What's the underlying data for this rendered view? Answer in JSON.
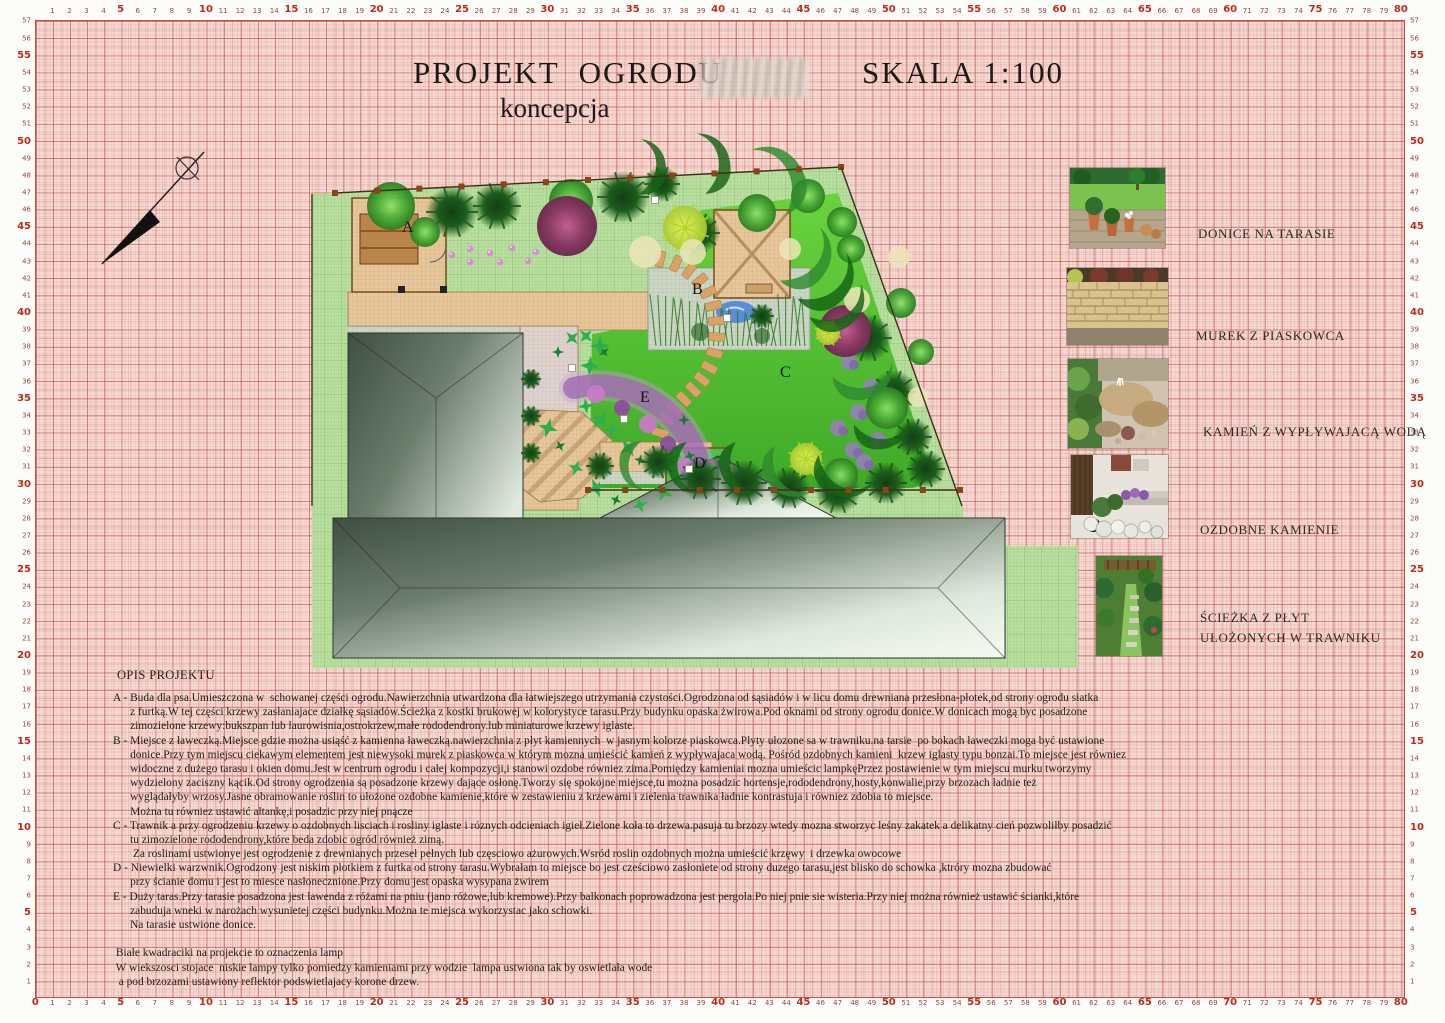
{
  "title": {
    "main": "PROJEKT  OGRODU",
    "scale": "SKALA 1:100",
    "subtitle": "koncepcja"
  },
  "legend": {
    "items": [
      {
        "caption": "DONICE NA TARASIE"
      },
      {
        "caption": "MUREK Z PIASKOWCA"
      },
      {
        "caption": "KAMIEŃ Z WYPŁYWAJACĄ WODĄ"
      },
      {
        "caption": "OZDOBNE KAMIENIE"
      },
      {
        "caption": "ŚCIEŻKA Z PŁYT\nUŁOŻONYCH W TRAWNIKU"
      }
    ]
  },
  "description": {
    "heading": "OPIS PROJEKTU",
    "lines": [
      "A - Buda dla psa.Umieszczona w  schowanej części ogrodu.Nawierzchnia utwardzona dla łatwiejszego utrzymania czystości.Ogrodzona od sąsiadów i w licu domu drewniana przesłona-płotek,od strony ogrodu siatka",
      "      z furtką.W tej części krzewy zasłaniajace działkę sąsiadów.Ścieżka z kostki brukowej w kolorystyce tarasu.Przy budynku opaska żwirowa.Pod oknami od strony ogrodu donice.W donicach mogą byc posadzone",
      "      zimozielone krzewy:bukszpan lub laurowisnia,ostrokrzew,małe rododendrony.lub miniaturowe krzewy iglaste.",
      "B - Miejsce z ławeczką.Miejsce gdzie można usiąść z kamienna ławeczką.nawierzchnia z płyt kamiennych  w jasnym kolorze piaskowca.Płyty ułozone sa w trawniku.na tarsie  po bokach ławeczki moga być ustawione",
      "      donice.Przy tym miejscu ciekawym elementem jest niewysoki murek z piaskowca w którym mozna umieścić kamień z wypływajaca wodą. Pośród ozdobnych kamieni  krzew iglasty typu bonzai.To miejsce jest równiez",
      "      widoczne z dużego tarasu i okien domu.Jest w centrum ogrodu i całej kompozycji,i stanowi ozdobe równiez zima.Pomiędzy kamieniai mozna umieścic lampkęPrzez postawienie w tym miejscu murku tworzymy",
      "      wydzielony zaciszny kącik.Od strony ogrodzenia są posadzone krzewy dające osłonę.Tworzy się spokojne miejsce,tu mozna posadzic hortensje,rododendrony,hosty,konwalie,przy brzozach ładnie też",
      "      wyglądałyby wrzosy.Jasne obramowanie roślin to ułożone ozdobne kamienie,które w zestawieniu z krzewami i zielenia trawnika ładnie kontrastuja i równiez zdobia to miejsce.",
      "      Można tu równiez ustawić altankę,i posadzic przy niej pnącze",
      "C - Trawnik a przy ogrodzeniu krzewy o ozdobnych lisciach i rosliny iglaste i róznych odcieniach igieł.Zielone koła to drzewa.pasuja tu brzozy wtedy mozna stworzyc leśny zakatek a delikatny cień pozwoliłby posadzić",
      "      tu zimozielone rododendrony,które beda zdobic ogród również zimą.",
      "       Za roslinami ustwionye jest ogrodzenie z drewnianych przeseł pełnych lub częsciowo ażurowych.Wsród roslin ozdobnych można umieścić krzęwy  i drzewka owocowe",
      "D - Niewielki warzwnik.Ogrodzony jest niskim płotkiem z furtka od strony tarasu.Wybrałam to miejsce bo jest cześciowo zasłoniete od strony duzego tarasu,jest blisko do schowka ,ktróry mozna zbudować",
      "      przy ścianie domu i jest to miesce nasłonecznione.Przy domu jest opaska wysypana żwirem",
      "E - Duży taras.Przy tarasie posadzona jest lawenda z różami na pniu (jano różowe,lub kremowe).Przy balkonach poprowadzona jest pergola.Po niej pnie sie wisteria.Przy niej można również ustawić ścianki,które",
      "      zabuduja wneki w narożach wysunietej części budynku.Można te miejsca wykorzystac jako schowki.",
      "      Na tarasie ustwione donice.",
      "",
      " Białe kwadraciki na projekcie to oznaczenia lamp",
      " W wiekszosci stojace  niskie lampy tylko pomiedzy kamieniami przy wodzie  lampa ustwiona tak by oswietlała wode",
      "  a pod brzozami ustawiony reflektor podswietlajacy korone drzew."
    ]
  },
  "rulers": {
    "top": {
      "from": 1,
      "to": 80,
      "overrides": {
        "70": "60"
      }
    },
    "bottom": {
      "from": 0,
      "to": 80,
      "overrides": {}
    },
    "left": {
      "from": 1,
      "to": 57
    },
    "right": {
      "from": 1,
      "to": 57
    }
  },
  "plan": {
    "labels": [
      {
        "t": "A",
        "x": 402,
        "y": 232
      },
      {
        "t": "B",
        "x": 692,
        "y": 294
      },
      {
        "t": "C",
        "x": 780,
        "y": 377
      },
      {
        "t": "D",
        "x": 694,
        "y": 468
      },
      {
        "t": "E",
        "x": 640,
        "y": 402
      }
    ],
    "trees": {
      "conif": [
        [
          452,
          212,
          26
        ],
        [
          497,
          206,
          24
        ],
        [
          623,
          197,
          26
        ],
        [
          662,
          184,
          18
        ],
        [
          700,
          233,
          20
        ],
        [
          868,
          338,
          24
        ],
        [
          894,
          392,
          22
        ],
        [
          913,
          437,
          19
        ],
        [
          658,
          462,
          17
        ],
        [
          700,
          479,
          21
        ],
        [
          744,
          483,
          23
        ],
        [
          789,
          488,
          21
        ],
        [
          838,
          491,
          23
        ],
        [
          886,
          483,
          21
        ],
        [
          926,
          469,
          19
        ],
        [
          531,
          379,
          10
        ],
        [
          531,
          416,
          10
        ],
        [
          531,
          453,
          10
        ],
        [
          600,
          466,
          14
        ],
        [
          762,
          316,
          12
        ]
      ],
      "decid": [
        [
          391,
          206,
          24
        ],
        [
          425,
          232,
          15
        ],
        [
          571,
          201,
          22
        ],
        [
          757,
          213,
          19
        ],
        [
          808,
          196,
          17
        ],
        [
          842,
          222,
          15
        ],
        [
          851,
          249,
          14
        ],
        [
          901,
          303,
          15
        ],
        [
          921,
          352,
          13
        ],
        [
          887,
          408,
          21
        ],
        [
          841,
          475,
          17
        ]
      ],
      "magenta": [
        [
          567,
          226,
          30
        ],
        [
          845,
          331,
          26
        ]
      ],
      "lime": [
        [
          685,
          228,
          22
        ],
        [
          806,
          459,
          16
        ],
        [
          828,
          333,
          12
        ]
      ],
      "cream": [
        [
          645,
          252,
          16
        ],
        [
          693,
          252,
          13
        ],
        [
          857,
          300,
          13
        ],
        [
          899,
          257,
          11
        ],
        [
          790,
          249,
          11
        ],
        [
          918,
          397,
          10
        ]
      ]
    },
    "swooshes": [
      [
        770,
        181,
        1.2,
        -30
      ],
      [
        702,
        163,
        1.0,
        -10
      ],
      [
        641,
        166,
        0.9,
        0
      ],
      [
        801,
        254,
        1.1,
        35
      ],
      [
        823,
        276,
        1.1,
        45
      ],
      [
        836,
        301,
        1.0,
        55
      ],
      [
        863,
        371,
        1.0,
        75
      ],
      [
        882,
        424,
        0.9,
        85
      ],
      [
        846,
        470,
        1.0,
        115
      ],
      [
        792,
        470,
        0.95,
        140
      ],
      [
        746,
        468,
        0.9,
        155
      ],
      [
        692,
        468,
        0.85,
        165
      ],
      [
        642,
        466,
        0.8,
        175
      ]
    ],
    "leaves": [
      [
        558,
        352
      ],
      [
        572,
        338
      ],
      [
        590,
        366
      ],
      [
        604,
        352
      ],
      [
        612,
        430
      ],
      [
        628,
        448
      ],
      [
        640,
        460
      ],
      [
        655,
        470
      ],
      [
        548,
        428
      ],
      [
        560,
        446
      ],
      [
        576,
        468
      ],
      [
        596,
        488
      ],
      [
        616,
        500
      ],
      [
        640,
        505
      ],
      [
        664,
        492
      ],
      [
        690,
        456
      ],
      [
        712,
        470
      ],
      [
        726,
        458
      ],
      [
        742,
        472
      ],
      [
        586,
        406
      ],
      [
        600,
        420
      ],
      [
        684,
        420
      ],
      [
        586,
        336
      ],
      [
        600,
        346
      ]
    ],
    "flowers": [
      [
        452,
        255
      ],
      [
        470,
        249
      ],
      [
        490,
        253
      ],
      [
        512,
        248
      ],
      [
        536,
        252
      ],
      [
        554,
        247
      ],
      [
        470,
        262
      ],
      [
        500,
        262
      ],
      [
        528,
        261
      ]
    ],
    "heather": [
      [
        849,
        362
      ],
      [
        871,
        387
      ],
      [
        858,
        412
      ],
      [
        838,
        428
      ],
      [
        878,
        440
      ],
      [
        853,
        450
      ],
      [
        864,
        462
      ]
    ],
    "roses": [
      [
        596,
        394,
        9
      ],
      [
        622,
        408,
        8
      ],
      [
        648,
        424,
        9
      ],
      [
        668,
        444,
        8
      ],
      [
        686,
        466,
        9
      ]
    ],
    "lamps": [
      [
        655,
        200
      ],
      [
        727,
        318
      ],
      [
        572,
        368
      ],
      [
        624,
        419
      ],
      [
        689,
        469
      ]
    ],
    "stone_segs": [
      [
        652,
        258,
        700,
        262,
        722,
        300,
        716,
        345
      ],
      [
        716,
        345,
        710,
        392,
        668,
        398,
        658,
        440
      ]
    ],
    "fences": [
      [
        335,
        193,
        841,
        167,
        12
      ],
      [
        588,
        490,
        960,
        490,
        10
      ],
      [
        841,
        167,
        962,
        506,
        0
      ],
      [
        312,
        194,
        312,
        506,
        0
      ]
    ]
  },
  "colors": {
    "paper_pink": "#f6dad5",
    "plot_green": "#badf9f",
    "lawn_green": "#55c335",
    "path_tan": "#e6c79b",
    "roof_dark": "#41523f",
    "accent_red": "#c22a18",
    "purple_arc": "#a06ab0"
  }
}
